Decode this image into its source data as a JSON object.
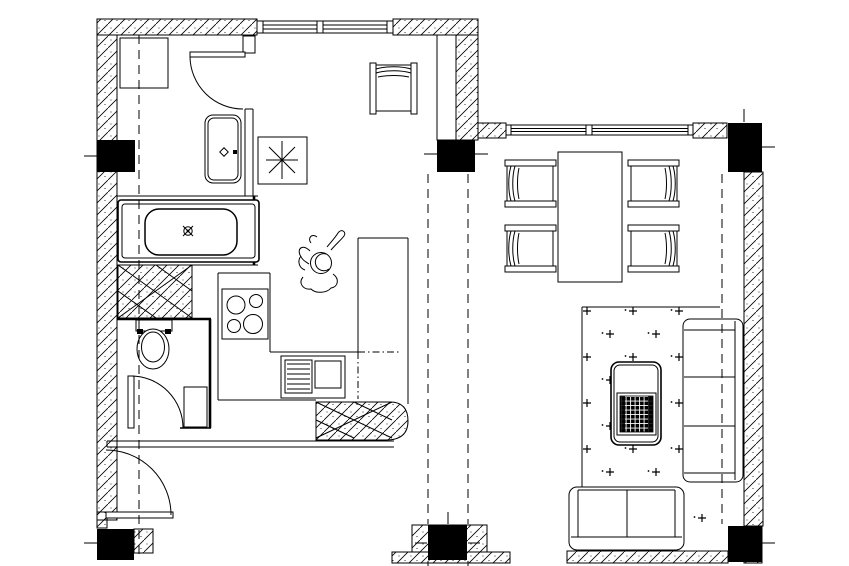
{
  "document": {
    "kind": "architectural floor plan",
    "style": "monochrome CAD line drawing, no text labels",
    "colors": {
      "paper": "#ffffff",
      "ink": "#000000",
      "column_fill": "#000000"
    }
  },
  "structure": {
    "walls": {
      "hatch_pattern": "45-degree diagonal lines with dots",
      "segments": [
        "top exterior wall of left wing with window",
        "left exterior wall",
        "top exterior wall of right wing with window",
        "right exterior wall",
        "bottom wall stubs at entrance and living room",
        "interior shaft wall beside kitchen",
        "cross-hatched kitchen end wall with rounded corner",
        "cross-hatched washing-machine pan between bath and toilet"
      ]
    },
    "columns": {
      "count": 6,
      "positions": [
        "top-left",
        "top-center",
        "top-right",
        "bottom-left",
        "bottom-center",
        "bottom-right"
      ]
    },
    "grid_lines": {
      "style": "dashed",
      "description": "vertical structural grid lines running through the columns"
    },
    "windows": [
      {
        "location": "top wall, left wing",
        "mullions": 1
      },
      {
        "location": "top wall, right wing",
        "mullions": 1
      }
    ],
    "doors": [
      {
        "location": "laundry room (top left)",
        "type": "swing with quarter-circle arc"
      },
      {
        "location": "toilet room",
        "type": "swing with quarter-circle arc"
      },
      {
        "location": "entrance (bottom left)",
        "type": "swing with quarter-circle arc"
      }
    ]
  },
  "rooms": [
    {
      "name": "laundry room",
      "furniture": [
        "washing machine square",
        "washbasin cabinet with diamond symbol"
      ]
    },
    {
      "name": "bathroom",
      "furniture": [
        "bathtub with drain symbol"
      ]
    },
    {
      "name": "toilet room",
      "furniture": [
        "toilet with tank",
        "corner basin"
      ]
    },
    {
      "name": "kitchen",
      "furniture": [
        "4-burner stove",
        "sink unit with drainboard",
        "L counter",
        "peninsula counter",
        "desk chair",
        "seated person figure",
        "square fixture with asterisk symbol"
      ]
    },
    {
      "name": "dining area",
      "furniture": [
        "rectangular dining table",
        "4 dining chairs"
      ]
    },
    {
      "name": "living area",
      "furniture": [
        "dotted rug",
        "coffee table with lattice tray",
        "three-seat sofa against right wall",
        "two-seat sofa at bottom"
      ]
    }
  ],
  "aria": {
    "plan": "apartment floor plan drawing",
    "bathtub": "bathtub",
    "washbasin": "washbasin cabinet",
    "washer": "washing machine",
    "toilet": "toilet",
    "stove": "four burner stove",
    "sink": "kitchen sink unit",
    "dining_table": "dining table",
    "dining_chair": "dining chair",
    "desk_chair": "desk chair",
    "person": "seated person figure",
    "rug": "dotted rug",
    "coffee_table": "coffee table",
    "sofa3": "three seat sofa",
    "sofa2": "two seat sofa",
    "column": "structural column",
    "window": "window",
    "door": "swing door",
    "asterisk_fixture": "fixture square with asterisk"
  }
}
